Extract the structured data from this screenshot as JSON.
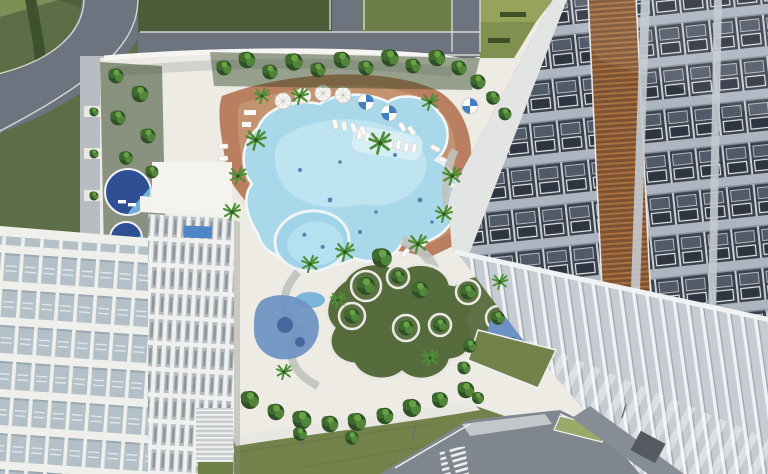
{
  "scene": {
    "type": "architectural-aerial-render",
    "description": "Aerial top-down 3D rendering of a resort-style residential complex: a free-form blue swimming pool with tan sun deck, white loungers and umbrellas sits on a landscaped podium between a white balcony tower (lower left) and a dark glass tower with wood louvers (right); lawns, curved garden paths, a kids pool, playgrounds, roads and a zebra crosswalk surround the site.",
    "camera": "top-down aerial",
    "time_of_day": "day"
  },
  "colors": {
    "deck_white": "#edebe4",
    "deck_tan": "#b97f60",
    "deck_tan_light": "#cda57d",
    "pool_water": "#a9d8ea",
    "pool_water_light": "#c9e9f4",
    "pool_edge": "#f3f7f8",
    "kids_pool": "#9fd3e8",
    "spa_navy": "#2e4f94",
    "spa_light": "#6fb3dc",
    "grass_dark": "#4a5c38",
    "grass_field": "#5c6e45",
    "grass_mid": "#6d7d49",
    "grass_terrace_a": "#96a35a",
    "grass_terrace_b": "#7f904f",
    "lawn_clover": "#576c3c",
    "lawn_south": "#72824a",
    "lawn_strip": "#9aa86a",
    "road": "#6e747f",
    "road_dark": "#80868e",
    "pavement": "#c3c7ca",
    "path_gray": "#b7bdc2",
    "curb_white": "#f2f3f1",
    "bed_dark": "#334a27",
    "tree_dark": "#2f4f26",
    "tree_light": "#67a344",
    "palm_green": "#4e8f35",
    "left_facade_glass": "#b4c0c8",
    "left_facade_white": "#eff0ec",
    "fin_face": "#b6bec2",
    "right_facade_dark": "#3a414d",
    "right_slab": "#adb5c0",
    "louver_brown": "#7c5233",
    "colonnade": "#c6ccd3",
    "playground_blue": "#6d91c2",
    "playground_blue_dark": "#49659d",
    "umbrella_blue": "#3f7fc2",
    "roof_pool_blue": "#4f86c8"
  },
  "objects": {
    "buildings": [
      "white-balcony-tower-left",
      "dark-glass-tower-right"
    ],
    "water_features": [
      "main-freeform-pool",
      "kids-pool",
      "spa-pool-upper",
      "spa-pool-lower",
      "rooftop-pool"
    ],
    "amenities": [
      "tan-sun-deck",
      "clover-lawn-with-tree-planters",
      "playground-left",
      "playground-right",
      "in-pool-lounger-ledge"
    ],
    "site": [
      "perimeter-roads",
      "zebra-crosswalk",
      "ground-colonnade",
      "stepped-lawn-terraces",
      "garden-paths"
    ],
    "umbrellas_white": 4,
    "umbrellas_blue": 3
  }
}
